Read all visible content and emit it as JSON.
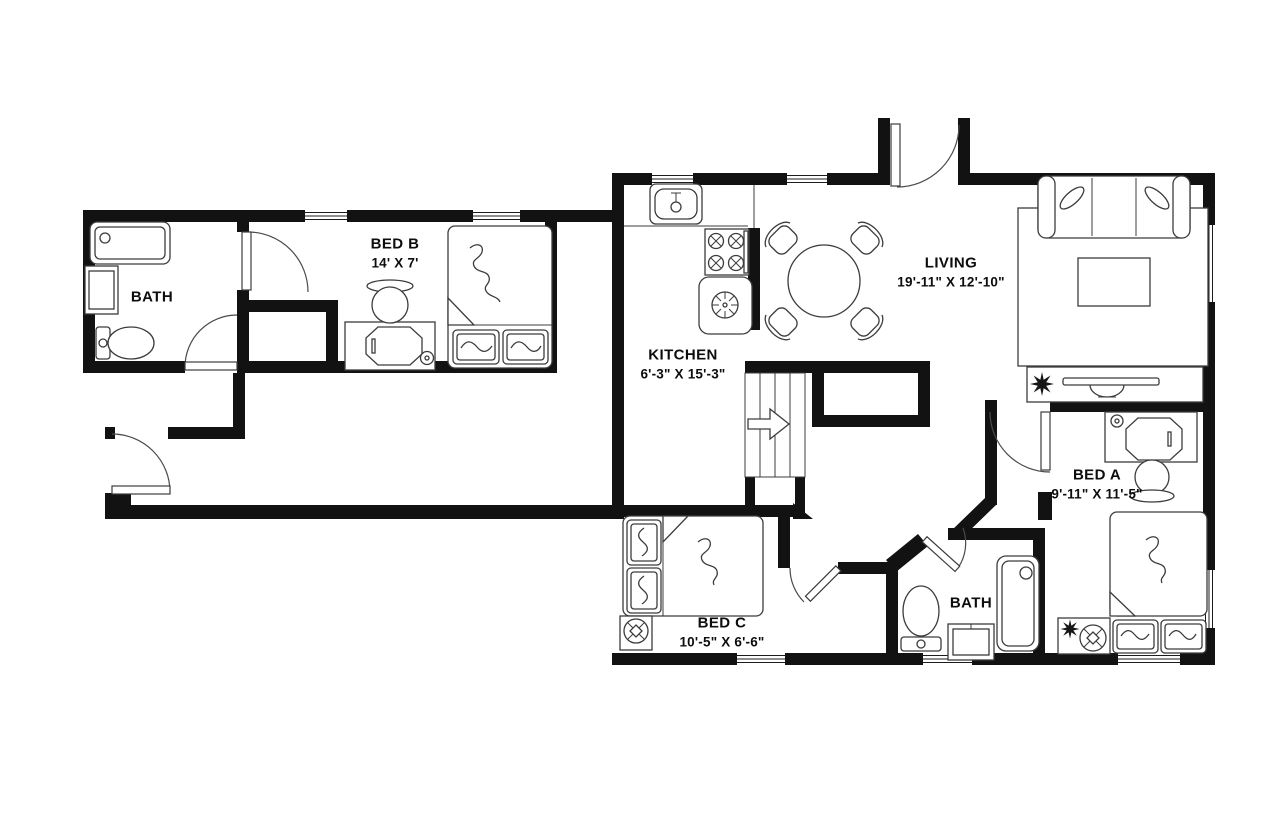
{
  "title": "apartment-floor-plan",
  "colors": {
    "background": "#ffffff",
    "walls": "#121212",
    "furniture_lines": "#3c3c3c",
    "text": "#0d0d0d"
  },
  "rooms": [
    {
      "id": "bath-left",
      "name": "BATH",
      "dims": ""
    },
    {
      "id": "bed-b",
      "name": "BED B",
      "dims": "14' X 7'"
    },
    {
      "id": "kitchen",
      "name": "KITCHEN",
      "dims": "6'-3\" X 15'-3\""
    },
    {
      "id": "living",
      "name": "LIVING",
      "dims": "19'-11\" X 12'-10\""
    },
    {
      "id": "bed-a",
      "name": "BED A",
      "dims": "9'-11\" X 11'-5\""
    },
    {
      "id": "bed-c",
      "name": "BED C",
      "dims": "10'-5\" X 6'-6\""
    },
    {
      "id": "bath-right",
      "name": "BATH",
      "dims": ""
    }
  ],
  "fixtures": {
    "bath_left": [
      "bathtub",
      "vanity",
      "toilet"
    ],
    "bath_right": [
      "bathtub",
      "vanity",
      "toilet"
    ],
    "kitchen": [
      "sink",
      "stove-4-burner",
      "refrigerator"
    ],
    "dining": [
      "round-table",
      "chairs-x4"
    ],
    "living": [
      "sofa",
      "rug",
      "coffee-table",
      "tv-console",
      "plant"
    ],
    "bed_a": [
      "desk",
      "chair",
      "double-bed",
      "pillows-x2",
      "nightstand",
      "lamp",
      "plant"
    ],
    "bed_b": [
      "desk",
      "chair",
      "double-bed",
      "pillows-x2"
    ],
    "bed_c": [
      "double-bed",
      "pillows-x2",
      "nightstand",
      "lamp"
    ],
    "circulation": [
      "entry-door",
      "interior-doors-x6",
      "stairs-up-arrow",
      "shaft-closet",
      "hallway",
      "windows-x8"
    ]
  }
}
